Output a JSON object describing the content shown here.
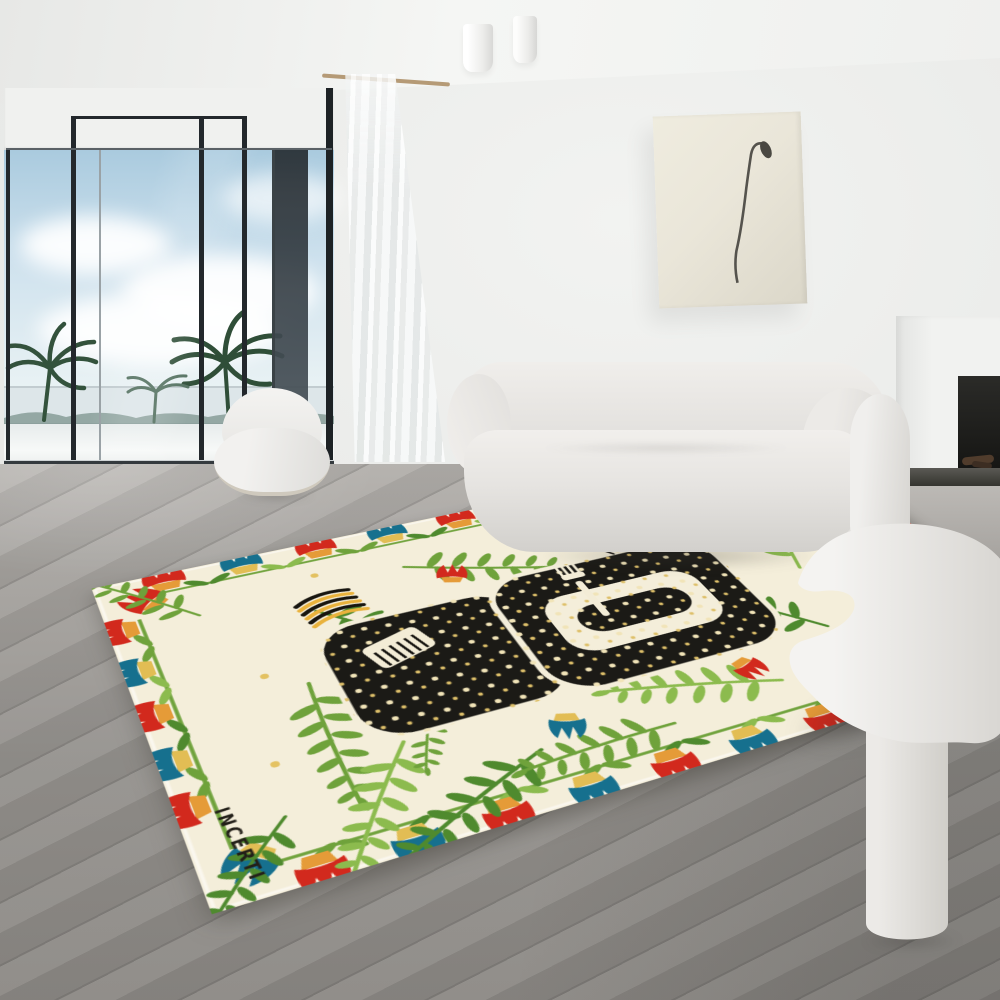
{
  "rug": {
    "signature": "INCERTI"
  },
  "css_vars": {
    "--wall": "#e8e9e7",
    "--ceiling-a": "#f5f6f4",
    "--sky-top": "#a9cade",
    "--sky-mid": "#cfe2ee",
    "--sky-low": "#e9f2f4",
    "--palm": "#33523c",
    "--frame": "#23282c",
    "--floor-a": "#b2afab",
    "--floor-b": "#8b8884",
    "--sofa-a": "#f0eeeb",
    "--sofa-b": "#d9d7d3",
    "--art-bg": "#eae6d9",
    "--hearth": "#35342f",
    "--rug-bg": "#f4eeda",
    "--rug-red": "#d2291d",
    "--rug-orange": "#e59b38",
    "--rug-teal": "#16708e",
    "--rug-gold": "#e2bd54",
    "--rug-black": "#1b1a16",
    "--rug-g1": "#4f8a2e",
    "--rug-g2": "#6fa23b",
    "--rug-g3": "#8cbb4e"
  }
}
